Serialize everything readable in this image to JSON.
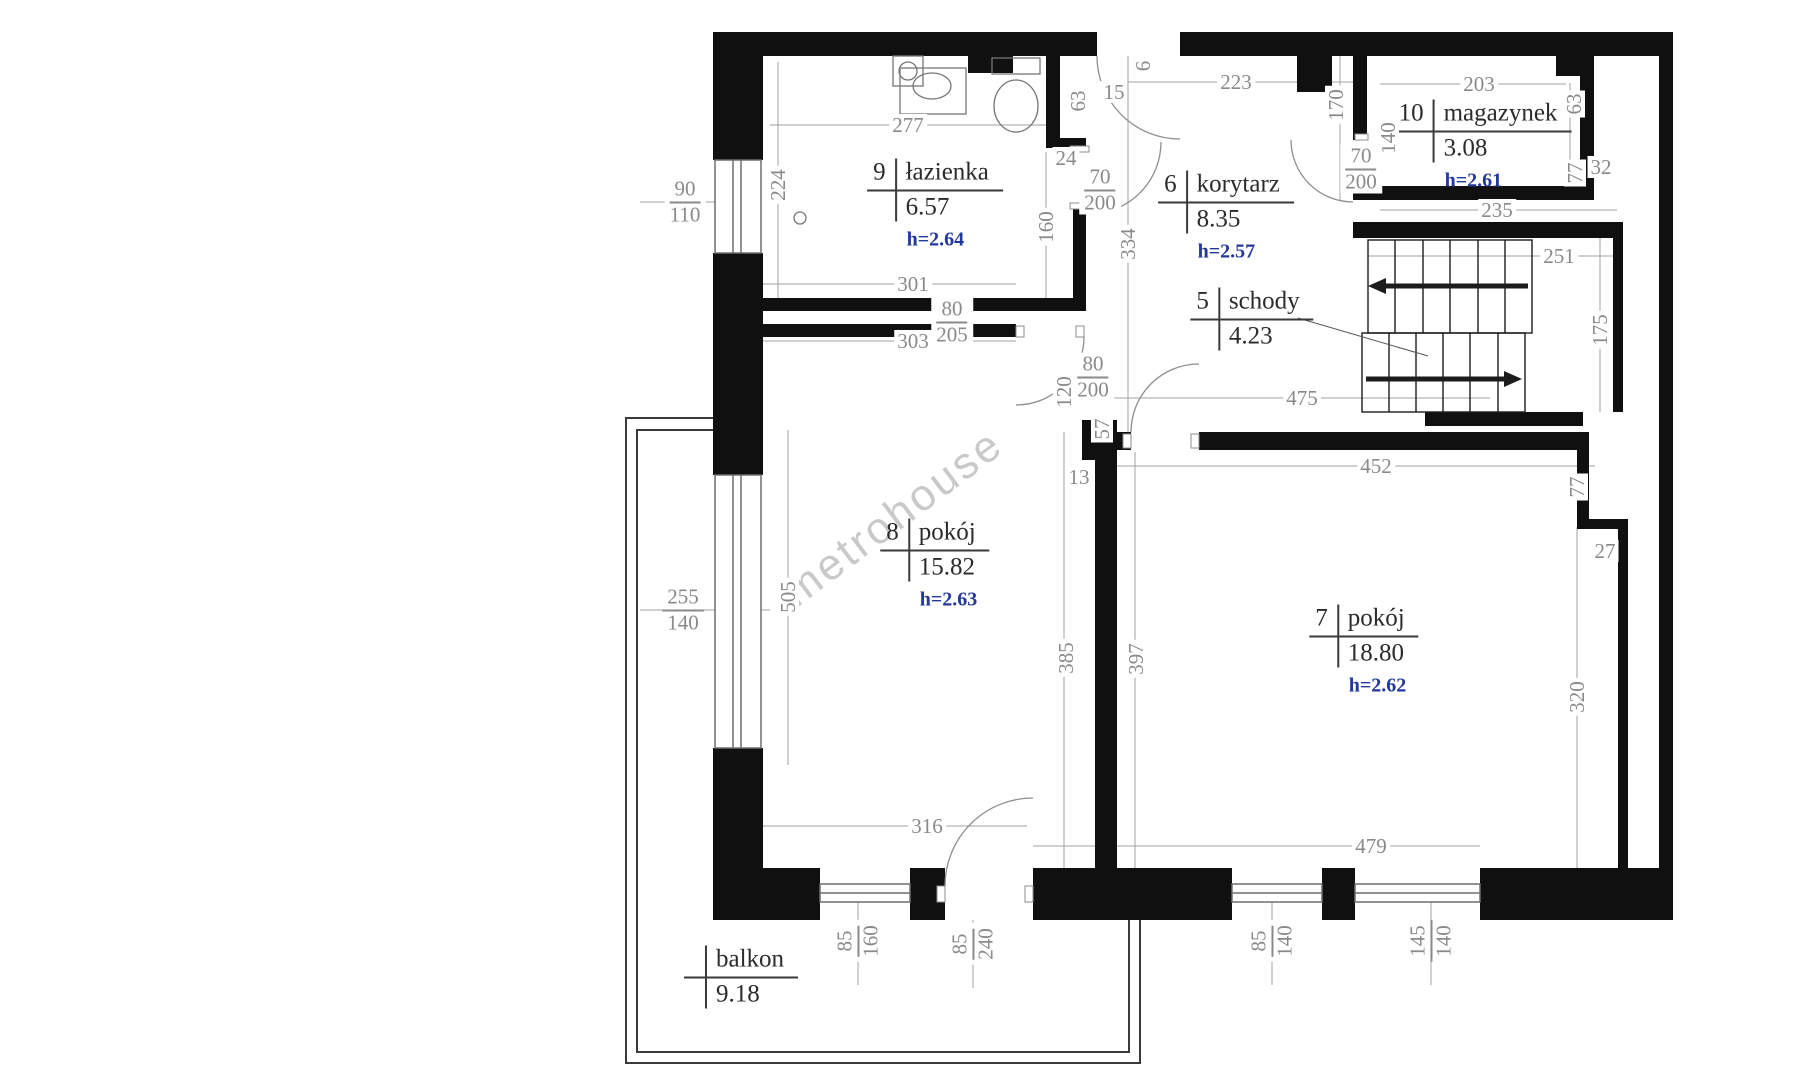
{
  "watermark": "metrohouse",
  "plan": {
    "rooms": [
      {
        "number": "9",
        "name": "łazienka",
        "area": "6.57",
        "height": "h=2.64",
        "x": 935,
        "y": 205
      },
      {
        "number": "6",
        "name": "korytarz",
        "area": "8.35",
        "height": "h=2.57",
        "x": 1226,
        "y": 217
      },
      {
        "number": "10",
        "name": "magazynek",
        "area": "3.08",
        "height": "h=2.61",
        "x": 1482,
        "y": 146
      },
      {
        "number": "5",
        "name": "schody",
        "area": "4.23",
        "height": "",
        "x": 1252,
        "y": 319
      },
      {
        "number": "8",
        "name": "pokój",
        "area": "15.82",
        "height": "h=2.63",
        "x": 935,
        "y": 565
      },
      {
        "number": "7",
        "name": "pokój",
        "area": "18.80",
        "height": "h=2.62",
        "x": 1364,
        "y": 651
      },
      {
        "number": "",
        "name": "balkon",
        "area": "9.18",
        "height": "",
        "x": 741,
        "y": 977
      }
    ],
    "dimensions": [
      {
        "text": "277",
        "x": 908,
        "y": 125,
        "rot": 0
      },
      {
        "text": "224",
        "x": 778,
        "y": 185,
        "rot": -90
      },
      {
        "text": "301",
        "x": 913,
        "y": 284,
        "rot": 0
      },
      {
        "text": "303",
        "x": 913,
        "y": 341,
        "rot": 0
      },
      {
        "text": "63",
        "x": 1078,
        "y": 101,
        "rot": -90
      },
      {
        "text": "24",
        "x": 1066,
        "y": 158,
        "rot": 0
      },
      {
        "text": "15",
        "x": 1114,
        "y": 92,
        "rot": 0
      },
      {
        "text": "6",
        "x": 1143,
        "y": 66,
        "rot": -90
      },
      {
        "text": "160",
        "x": 1046,
        "y": 227,
        "rot": -90
      },
      {
        "text": "334",
        "x": 1128,
        "y": 244,
        "rot": -90
      },
      {
        "text": "223",
        "x": 1236,
        "y": 82,
        "rot": 0
      },
      {
        "text": "170",
        "x": 1336,
        "y": 105,
        "rot": -90
      },
      {
        "text": "140",
        "x": 1388,
        "y": 138,
        "rot": -90
      },
      {
        "text": "203",
        "x": 1479,
        "y": 84,
        "rot": 0
      },
      {
        "text": "63",
        "x": 1574,
        "y": 104,
        "rot": -90
      },
      {
        "text": "32",
        "x": 1601,
        "y": 167,
        "rot": 0
      },
      {
        "text": "77",
        "x": 1575,
        "y": 173,
        "rot": -90
      },
      {
        "text": "235",
        "x": 1497,
        "y": 210,
        "rot": 0
      },
      {
        "text": "251",
        "x": 1559,
        "y": 256,
        "rot": 0
      },
      {
        "text": "175",
        "x": 1600,
        "y": 330,
        "rot": -90
      },
      {
        "text": "475",
        "x": 1302,
        "y": 398,
        "rot": 0
      },
      {
        "text": "120",
        "x": 1064,
        "y": 392,
        "rot": -90
      },
      {
        "text": "13",
        "x": 1079,
        "y": 477,
        "rot": 0
      },
      {
        "text": "57",
        "x": 1102,
        "y": 429,
        "rot": -90
      },
      {
        "text": "452",
        "x": 1376,
        "y": 466,
        "rot": 0
      },
      {
        "text": "77",
        "x": 1577,
        "y": 487,
        "rot": -90
      },
      {
        "text": "27",
        "x": 1605,
        "y": 551,
        "rot": 0
      },
      {
        "text": "505",
        "x": 788,
        "y": 597,
        "rot": -90
      },
      {
        "text": "385",
        "x": 1066,
        "y": 658,
        "rot": -90
      },
      {
        "text": "397",
        "x": 1136,
        "y": 659,
        "rot": -90
      },
      {
        "text": "320",
        "x": 1577,
        "y": 697,
        "rot": -90
      },
      {
        "text": "316",
        "x": 927,
        "y": 826,
        "rot": 0
      },
      {
        "text": "479",
        "x": 1371,
        "y": 846,
        "rot": 0
      }
    ],
    "openings": [
      {
        "top": "90",
        "bottom": "110",
        "x": 685,
        "y": 202,
        "rot": 0
      },
      {
        "top": "70",
        "bottom": "200",
        "x": 1100,
        "y": 190,
        "rot": 0
      },
      {
        "top": "70",
        "bottom": "200",
        "x": 1361,
        "y": 169,
        "rot": 0
      },
      {
        "top": "80",
        "bottom": "205",
        "x": 952,
        "y": 322,
        "rot": 0
      },
      {
        "top": "80",
        "bottom": "200",
        "x": 1093,
        "y": 377,
        "rot": 0
      },
      {
        "top": "255",
        "bottom": "140",
        "x": 683,
        "y": 610,
        "rot": 0
      },
      {
        "top": "85",
        "bottom": "160",
        "x": 858,
        "y": 941,
        "rot": -90
      },
      {
        "top": "85",
        "bottom": "240",
        "x": 973,
        "y": 944,
        "rot": -90
      },
      {
        "top": "85",
        "bottom": "140",
        "x": 1272,
        "y": 941,
        "rot": -90
      },
      {
        "top": "145",
        "bottom": "140",
        "x": 1431,
        "y": 941,
        "rot": -90
      }
    ]
  }
}
